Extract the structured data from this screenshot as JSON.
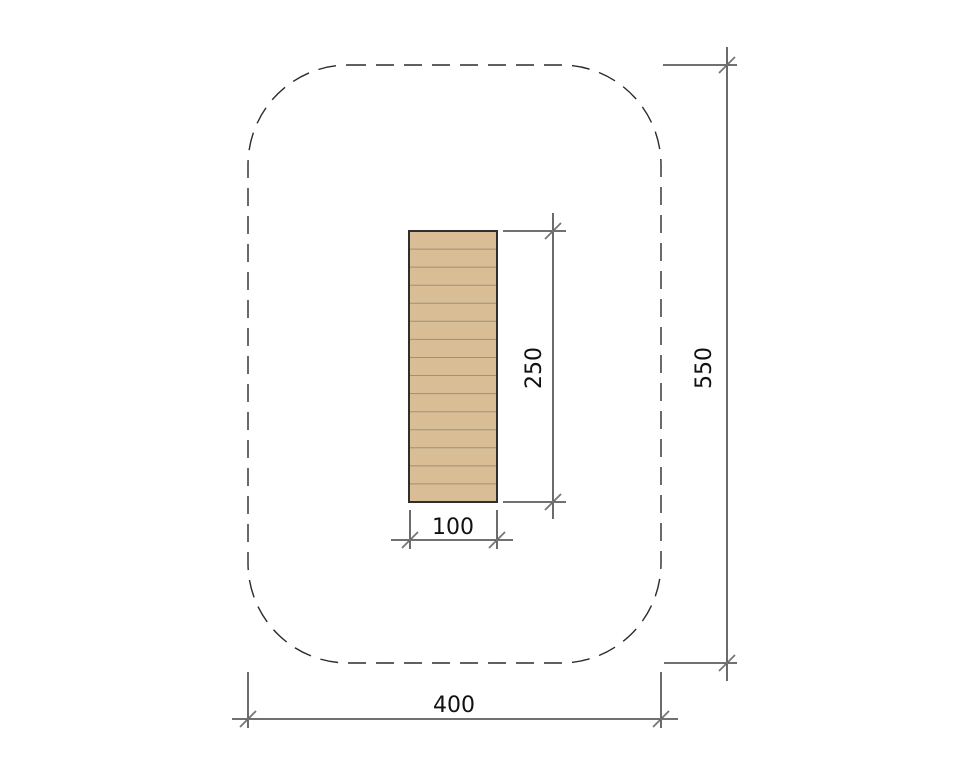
{
  "drawing": {
    "description": "plan-view technical drawing of plank equipment inside dashed safety area",
    "colors": {
      "background": "#ffffff",
      "line": "#1c1c1c",
      "dashed_outline": "#2b2b2b",
      "tick": "#757575",
      "text": "#111111",
      "plank_fill": "#d9bd94",
      "plank_line": "#9a9181",
      "plank_border": "#2f2f2f"
    },
    "equipment": {
      "plank_segments": 15
    },
    "dimensions": {
      "plank_height_label": "250",
      "plank_width_label": "100",
      "area_height_label": "550",
      "area_width_label": "400"
    }
  }
}
